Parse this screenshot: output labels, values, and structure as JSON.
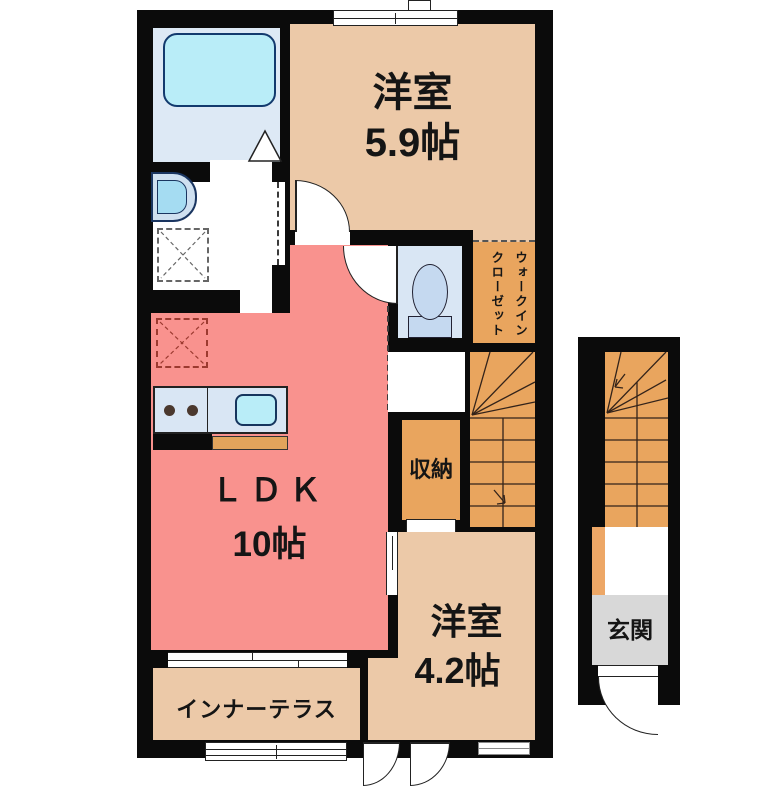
{
  "floorplan": {
    "floor2": {
      "bedroom1": {
        "label": "洋室",
        "size": "5.9帖"
      },
      "walk_in_closet": {
        "line1": "ウォークイン",
        "line2": "クローゼット"
      },
      "ldk": {
        "label": "ＬＤＫ",
        "size": "10帖"
      },
      "storage": {
        "label": "収納"
      },
      "bedroom2": {
        "label": "洋室",
        "size": "4.2帖"
      },
      "inner_terrace": {
        "label": "インナーテラス"
      }
    },
    "floor1": {
      "entrance": {
        "label": "玄関"
      }
    },
    "colors": {
      "wall": "#0b0b0b",
      "room_floor": "#ecc9a8",
      "ldk_floor": "#f9928e",
      "closet_stairs_floor": "#e9a55e",
      "wet_area_floor": "#d9e6f4",
      "bathtub": "#b9edf8",
      "entrance_floor": "#d8d8d8"
    }
  }
}
